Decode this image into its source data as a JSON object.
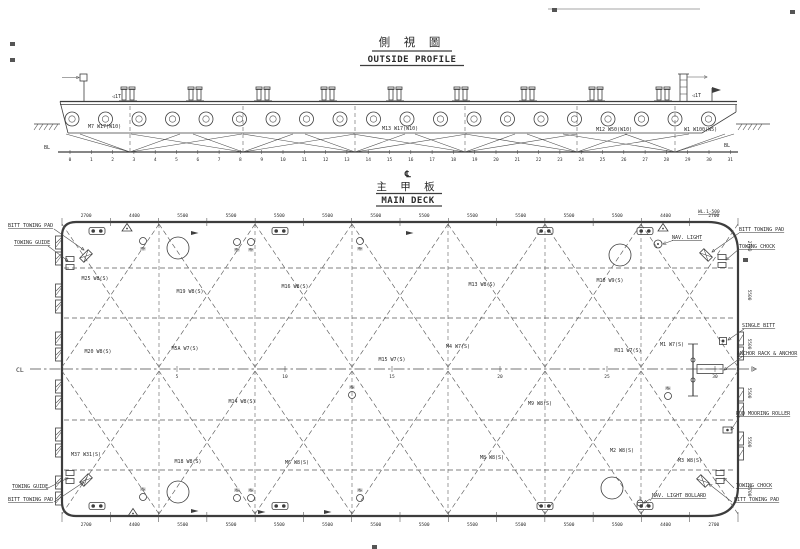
{
  "colors": {
    "ink": "#3d3d3d",
    "background": "#ffffff"
  },
  "profile": {
    "title_cn": "側 視 圖",
    "title_en": "OUTSIDE PROFILE",
    "bl_left": "BL",
    "bl_right": "BL",
    "stations": {
      "count": 32,
      "x0": 70,
      "dx": 21.3,
      "y": 161
    },
    "bollard_xs": [
      128,
      195,
      263,
      328,
      395,
      461,
      528,
      596,
      663
    ],
    "fenders": {
      "x0": 72,
      "dx": 33.5,
      "count": 20,
      "y": 119,
      "r": 7
    },
    "fan_apexes": [
      130,
      243,
      355,
      465,
      577,
      675
    ],
    "labels": [
      {
        "t": "M7 W17(W10)",
        "x": 88,
        "y": 128
      },
      {
        "t": "M13 W17(W10)",
        "x": 382,
        "y": 130
      },
      {
        "t": "M12 W50(W10)",
        "x": 596,
        "y": 131
      },
      {
        "t": "W1 W100(W5)",
        "x": 684,
        "y": 131
      }
    ],
    "side_notes": [
      {
        "t": "◁1T",
        "x": 112,
        "y": 98
      },
      {
        "t": "◁1T",
        "x": 692,
        "y": 97
      }
    ]
  },
  "deck": {
    "cl_symbol": "℄",
    "title_cn": "主 甲 板",
    "title_en": "MAIN DECK",
    "corner_note": "WL.1-500",
    "cl_label": "CL",
    "mh_label": "MH",
    "corner_labels": {
      "tl": [
        "BITT TOWING PAD",
        "TOWING GUIDE"
      ],
      "tr": [
        "BITT TOWING PAD",
        "TOWING CHOCK"
      ],
      "br": [
        "TOWING CHOCK",
        "BITT TOWING PAD"
      ],
      "bl": [
        "TOWING GUIDE",
        "BITT TOWING PAD"
      ]
    },
    "side_labels": {
      "single_bitt": "SINGLE BITT",
      "anchor": "ANCHOR RACK & ANCHOR",
      "roller": "ROD MOORING ROLLER",
      "nav_light": "NAV. LIGHT",
      "nav_light_bollard": "NAV. LIGHT BOLLARD"
    },
    "plate_labels": [
      {
        "t": "M25 W8(S)",
        "x": 95,
        "y": 280
      },
      {
        "t": "M19 W8(S)",
        "x": 190,
        "y": 293
      },
      {
        "t": "M16 W8(S)",
        "x": 295,
        "y": 288
      },
      {
        "t": "M13 W8(S)",
        "x": 482,
        "y": 286
      },
      {
        "t": "M10 W9(S)",
        "x": 610,
        "y": 282
      },
      {
        "t": "M20 W8(S)",
        "x": 98,
        "y": 353
      },
      {
        "t": "M5A W7(S)",
        "x": 185,
        "y": 350
      },
      {
        "t": "M15 W7(S)",
        "x": 392,
        "y": 361
      },
      {
        "t": "M4 W7(S)",
        "x": 458,
        "y": 348
      },
      {
        "t": "M11 W7(S)",
        "x": 628,
        "y": 352
      },
      {
        "t": "M1 W7(S)",
        "x": 672,
        "y": 346
      },
      {
        "t": "M14 W8(S)",
        "x": 242,
        "y": 403
      },
      {
        "t": "M9 W8(S)",
        "x": 540,
        "y": 405
      },
      {
        "t": "M37 W31(S)",
        "x": 86,
        "y": 456
      },
      {
        "t": "M18 W8(S)",
        "x": 188,
        "y": 463
      },
      {
        "t": "M6 W8(S)",
        "x": 297,
        "y": 464
      },
      {
        "t": "M8 W8(S)",
        "x": 492,
        "y": 459
      },
      {
        "t": "M2 W8(S)",
        "x": 622,
        "y": 452
      },
      {
        "t": "M3 W8(S)",
        "x": 690,
        "y": 462
      }
    ],
    "dims_top": [
      "2700",
      "4400",
      "5500",
      "5500",
      "5500",
      "5500",
      "5500",
      "5500",
      "5500",
      "5500",
      "5500",
      "5500",
      "4400",
      "2700"
    ],
    "dims_bottom": [
      "2700",
      "4400",
      "5500",
      "5500",
      "5500",
      "5500",
      "5500",
      "5500",
      "5500",
      "5500",
      "5500",
      "5500",
      "4400",
      "2700"
    ],
    "dims_right": [
      "2700",
      "5500",
      "5500",
      "5500",
      "5500",
      "2700"
    ],
    "cl_stations": [
      {
        "n": "5",
        "x": 177
      },
      {
        "n": "10",
        "x": 285
      },
      {
        "n": "15",
        "x": 392
      },
      {
        "n": "20",
        "x": 500
      },
      {
        "n": "25",
        "x": 607
      },
      {
        "n": "30",
        "x": 715
      }
    ],
    "lattice_cols": [
      62,
      159,
      255,
      352,
      448,
      545,
      641,
      738
    ],
    "seam_ys": [
      268,
      318,
      420,
      470
    ],
    "station_line_xs": [
      159,
      255,
      352,
      448,
      545,
      641
    ],
    "bitts_top_x": [
      97,
      280,
      545,
      645
    ],
    "bitts_bottom_x": [
      97,
      280,
      545,
      645
    ],
    "mh_points": [
      {
        "x": 143,
        "y": 241
      },
      {
        "x": 237,
        "y": 242
      },
      {
        "x": 251,
        "y": 242
      },
      {
        "x": 360,
        "y": 241
      },
      {
        "x": 143,
        "y": 497
      },
      {
        "x": 237,
        "y": 498
      },
      {
        "x": 251,
        "y": 498
      },
      {
        "x": 360,
        "y": 498
      },
      {
        "x": 352,
        "y": 395
      },
      {
        "x": 668,
        "y": 396
      }
    ],
    "circles": [
      [
        178,
        248
      ],
      [
        620,
        255
      ],
      [
        178,
        492
      ],
      [
        612,
        488
      ]
    ],
    "triangles": [
      [
        127,
        227
      ],
      [
        663,
        227
      ],
      [
        133,
        512
      ]
    ],
    "arrows": [
      [
        195,
        233
      ],
      [
        410,
        233
      ],
      [
        195,
        511
      ],
      [
        262,
        512
      ],
      [
        328,
        512
      ]
    ],
    "fenders_left_y": [
      236,
      252,
      284,
      300,
      332,
      348,
      380,
      396,
      428,
      444,
      476,
      492
    ],
    "fenders_right_y": [
      332,
      347,
      388,
      403,
      432,
      447
    ],
    "pads": [
      [
        86,
        256,
        -45
      ],
      [
        706,
        255,
        45
      ],
      [
        703,
        481,
        225
      ],
      [
        86,
        480,
        135
      ]
    ],
    "chocks": [
      [
        70,
        263
      ],
      [
        722,
        261
      ],
      [
        720,
        477
      ],
      [
        70,
        477
      ]
    ]
  },
  "specks": [
    [
      10,
      42
    ],
    [
      10,
      58
    ],
    [
      790,
      10
    ],
    [
      552,
      8
    ],
    [
      372,
      545
    ],
    [
      743,
      258
    ]
  ]
}
